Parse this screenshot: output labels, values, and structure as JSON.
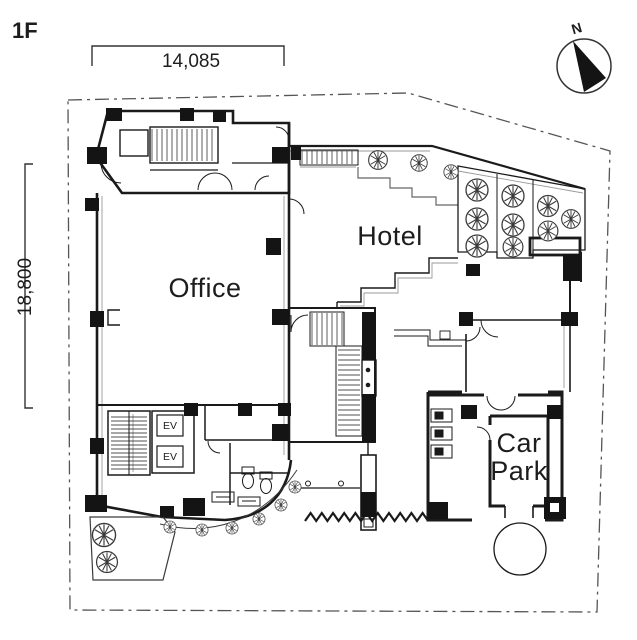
{
  "drawing": {
    "floor_label": "1F",
    "compass_label": "N",
    "dimensions": {
      "width_label": "14,085",
      "height_label": "18,800"
    },
    "rooms": {
      "office": "Office",
      "hotel": "Hotel",
      "car_park_line1": "Car",
      "car_park_line2": "Park",
      "elevator_1": "EV",
      "elevator_2": "EV"
    },
    "colors": {
      "ink": "#1a1a1a",
      "line_gray": "#8a8a8a",
      "boundary": "#555555",
      "paper": "#ffffff"
    }
  }
}
